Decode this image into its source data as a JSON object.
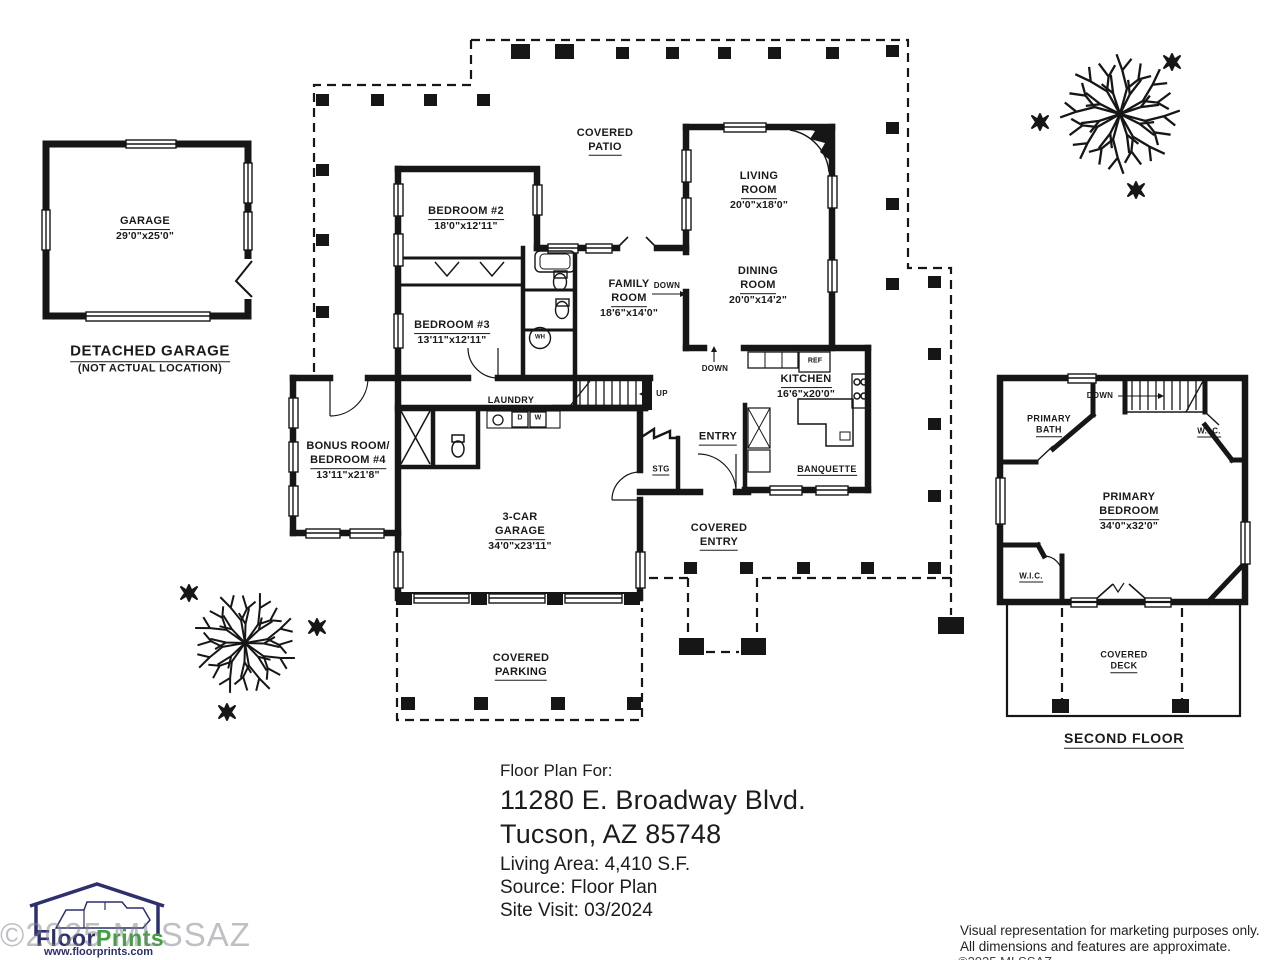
{
  "plan": {
    "detached_garage": {
      "room": "GARAGE",
      "dims": "29'0\"x25'0\"",
      "caption": "DETACHED GARAGE",
      "note": "(NOT ACTUAL LOCATION)"
    },
    "first_floor": {
      "covered_patio": {
        "l1": "COVERED",
        "l2": "PATIO"
      },
      "bedroom2": {
        "room": "BEDROOM #2",
        "dims": "18'0\"x12'11\""
      },
      "bedroom3": {
        "room": "BEDROOM #3",
        "dims": "13'11\"x12'11\""
      },
      "family_room": {
        "l1": "FAMILY",
        "l2": "ROOM",
        "dims": "18'6\"x14'0\""
      },
      "living_room": {
        "l1": "LIVING",
        "l2": "ROOM",
        "dims": "20'0\"x18'0\""
      },
      "dining_room": {
        "l1": "DINING",
        "l2": "ROOM",
        "dims": "20'0\"x14'2\""
      },
      "kitchen": {
        "room": "KITCHEN",
        "dims": "16'6\"x20'0\""
      },
      "bonus_room": {
        "l1": "BONUS ROOM/",
        "l2": "BEDROOM #4",
        "dims": "13'11\"x21'8\""
      },
      "car_garage": {
        "l1": "3-CAR",
        "l2": "GARAGE",
        "dims": "34'0\"x23'11\""
      },
      "covered_entry": {
        "l1": "COVERED",
        "l2": "ENTRY"
      },
      "covered_parking": {
        "l1": "COVERED",
        "l2": "PARKING"
      },
      "banquette": "BANQUETTE",
      "entry": "ENTRY",
      "stg": "STG",
      "laundry": "LAUNDRY",
      "up": "UP",
      "down": "DOWN",
      "ref": "REF",
      "wh": "WH",
      "dryer": "D",
      "washer": "W"
    },
    "second_floor": {
      "primary_bath": {
        "l1": "PRIMARY",
        "l2": "BATH"
      },
      "primary_bedroom": {
        "l1": "PRIMARY",
        "l2": "BEDROOM",
        "dims": "34'0\"x32'0\""
      },
      "wic": "W.I.C.",
      "down": "DOWN",
      "covered_deck": {
        "l1": "COVERED",
        "l2": "DECK"
      },
      "caption": "SECOND FLOOR"
    }
  },
  "info": {
    "heading": "Floor Plan For:",
    "address_line1": "11280 E. Broadway Blvd.",
    "address_line2": "Tucson, AZ  85748",
    "living_area": "Living Area:  4,410 S.F.",
    "source": "Source:  Floor Plan",
    "site_visit": "Site Visit:  03/2024"
  },
  "branding": {
    "logo_floor": "Floor",
    "logo_prints": "Prints",
    "logo_url": "www.floorprints.com",
    "logo_navy": "#2e2f6e",
    "logo_green": "#3fa33c",
    "watermark": "©2025 MLSSAZ"
  },
  "disclaimer": {
    "line1": "Visual representation for marketing purposes only.",
    "line2": "All dimensions and features are approximate."
  }
}
